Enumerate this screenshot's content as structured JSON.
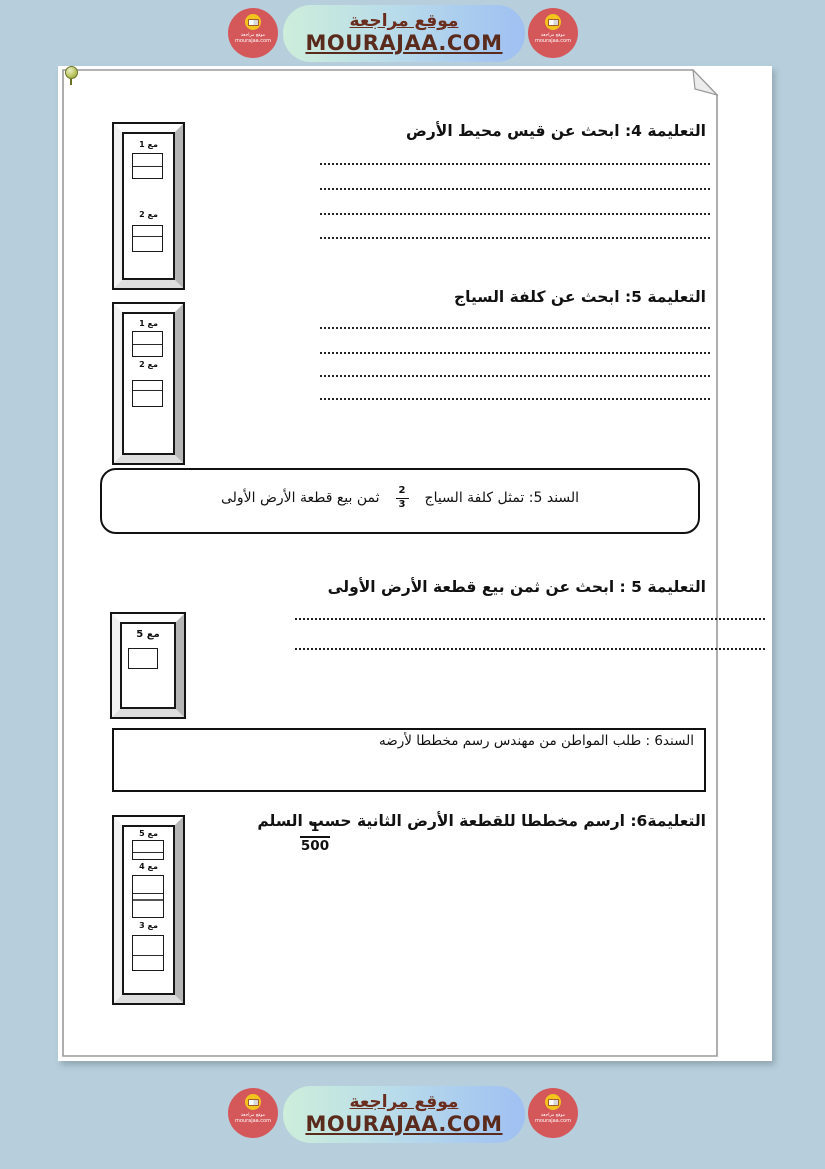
{
  "banner": {
    "title_ar": "موقع مراجعة",
    "site": "MOURAJAA.COM"
  },
  "badge": {
    "line1": "موقع مراجعة",
    "line2": "mourajaa.com"
  },
  "instructions": {
    "t4": "التعليمة 4: ابحث عن قيس محيط الأرض",
    "t5a": "التعليمة 5: ابحث عن كلفة السياج",
    "t5b": "التعليمة 5 : ابحث عن ثمن بيع قطعة الأرض الأولى",
    "t6": "التعليمة6: ارسم مخططا للقطعة الأرض الثانية حسب السلم"
  },
  "sanad5": {
    "before": "السند 5: تمثل كلفة السياج",
    "frac_num": "2",
    "frac_den": "3",
    "after": "ثمن بيع قطعة الأرض الأولى"
  },
  "sanad6": {
    "text": "السند6 : طلب المواطن من مهندس رسم مخططا لأرضه"
  },
  "scale_fraction": {
    "num": "1",
    "den": "500"
  },
  "frames": [
    {
      "items": [
        {
          "label": "مع 1"
        },
        {
          "label": "مع 2"
        }
      ]
    },
    {
      "items": [
        {
          "label": "مع 1"
        },
        {
          "label": "مع 2"
        }
      ]
    },
    {
      "items": [
        {
          "label": "مع 5"
        }
      ]
    },
    {
      "items": [
        {
          "label": "مع 5"
        },
        {
          "label": "مع 4"
        },
        {
          "label": "مع 3"
        }
      ]
    }
  ],
  "colors": {
    "background": "#b7cfdc",
    "badge_red": "#d4575a",
    "badge_yellow": "#f2c41d",
    "banner_gradient_start": "#cdeeda",
    "banner_gradient_end": "#9fc0f2",
    "banner_text": "#5a2a1c",
    "page_border": "#9a9a9a"
  }
}
